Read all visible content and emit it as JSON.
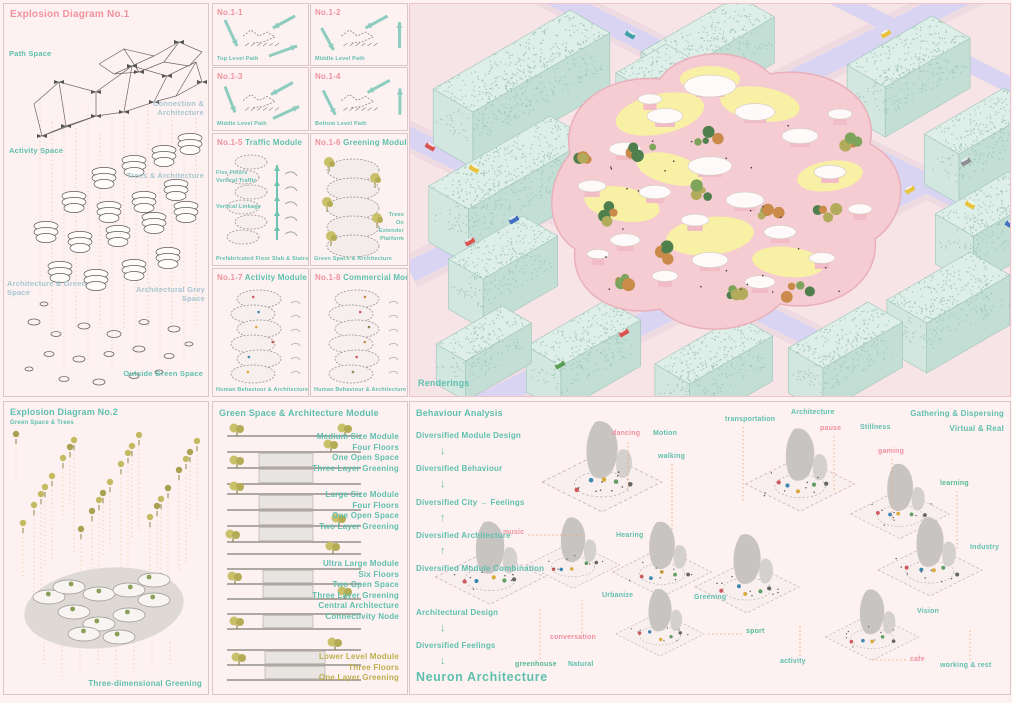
{
  "icons": {
    "arrow_down": "↓",
    "arrow_up": "↑",
    "arrow_right": "→"
  },
  "exp1": {
    "title": "Explosion Diagram No.1",
    "path_space": "Path Space",
    "connection": "Connection & Architecture",
    "activity": "Activity Space",
    "trees": "Trees & Architecture",
    "arch_green": "Architecture & Green Space",
    "arch_grey": "Architectural Grey Space",
    "outside": "Outside Green Space"
  },
  "modules": {
    "m11": {
      "no": "No.1-1",
      "caption": "Top Level Path"
    },
    "m12": {
      "no": "No.1-2",
      "caption": "Middle Level Path"
    },
    "m13": {
      "no": "No.1-3",
      "caption": "Middle Level Path"
    },
    "m14": {
      "no": "No.1-4",
      "caption": "Bottom Level Path"
    },
    "m15": {
      "no": "No.1-5",
      "name": "Traffic Module",
      "l1": "Five Floors",
      "l2": "Vertical Traffic",
      "l3": "Vertical Linkage",
      "caption": "Prefabricated Floor Slab & Stairs"
    },
    "m16": {
      "no": "No.1-6",
      "name": "Greening Module",
      "s1": "Trees",
      "s2": "On",
      "s3": "Extender",
      "s4": "Platform",
      "caption": "Green Space & Architecture"
    },
    "m17": {
      "no": "No.1-7",
      "name": "Activity Module",
      "caption": "Human Behaviour & Architecture"
    },
    "m18": {
      "no": "No.1-8",
      "name": "Commercial Module",
      "caption": "Human Behaviour & Architecture"
    }
  },
  "render": {
    "caption": "Renderings"
  },
  "exp2": {
    "title": "Explosion Diagram No.2",
    "subtitle": "Green Space & Trees",
    "label": "Three-dimensional Greening"
  },
  "green": {
    "title": "Green Space & Architecture Module",
    "blocks": [
      {
        "lines": [
          "Medium Size Module",
          "Four Floors",
          "One Open Space",
          "Three Layer Greening"
        ]
      },
      {
        "lines": [
          "Large Size Module",
          "Four Floors",
          "One Open Space",
          "Two Layer Greening"
        ]
      },
      {
        "lines": [
          "Ultra Large Module",
          "Six Floors",
          "Two Open Space",
          "Three Layer Greening",
          "Central Architecture",
          "Connectivity Node"
        ]
      },
      {
        "lines": [
          "Lower Level Module",
          "Three Floors",
          "One Layer Greening"
        ]
      }
    ]
  },
  "behaviour": {
    "title": "Behaviour Analysis",
    "flow": {
      "f0": "Diversified Module Design",
      "f1": "Diversified Behaviour",
      "f2": "Diversified City",
      "f2b": "Feelings",
      "f3": "Diversified Architecture",
      "f4": "Diversified Module Combination",
      "f5": "Architectural Design",
      "f6": "Diversified Feelings",
      "f7": "Neuron Architecture"
    },
    "corner1": "Gathering & Dispersing",
    "corner2": "Virtual & Real",
    "tags": [
      {
        "text": "dancing"
      },
      {
        "text": "Motion"
      },
      {
        "text": "walking"
      },
      {
        "text": "transportation"
      },
      {
        "text": "Architecture"
      },
      {
        "text": "pause"
      },
      {
        "text": "Stillness"
      },
      {
        "text": "gaming"
      },
      {
        "text": "learning"
      },
      {
        "text": "music"
      },
      {
        "text": "Hearing"
      },
      {
        "text": "Industry"
      },
      {
        "text": "Urbanize"
      },
      {
        "text": "Greening"
      },
      {
        "text": "Vision"
      },
      {
        "text": "sport"
      },
      {
        "text": "conversation"
      },
      {
        "text": "activity"
      },
      {
        "text": "greenhouse"
      },
      {
        "text": "Natural"
      },
      {
        "text": "cafe"
      },
      {
        "text": "working & rest"
      }
    ]
  }
}
